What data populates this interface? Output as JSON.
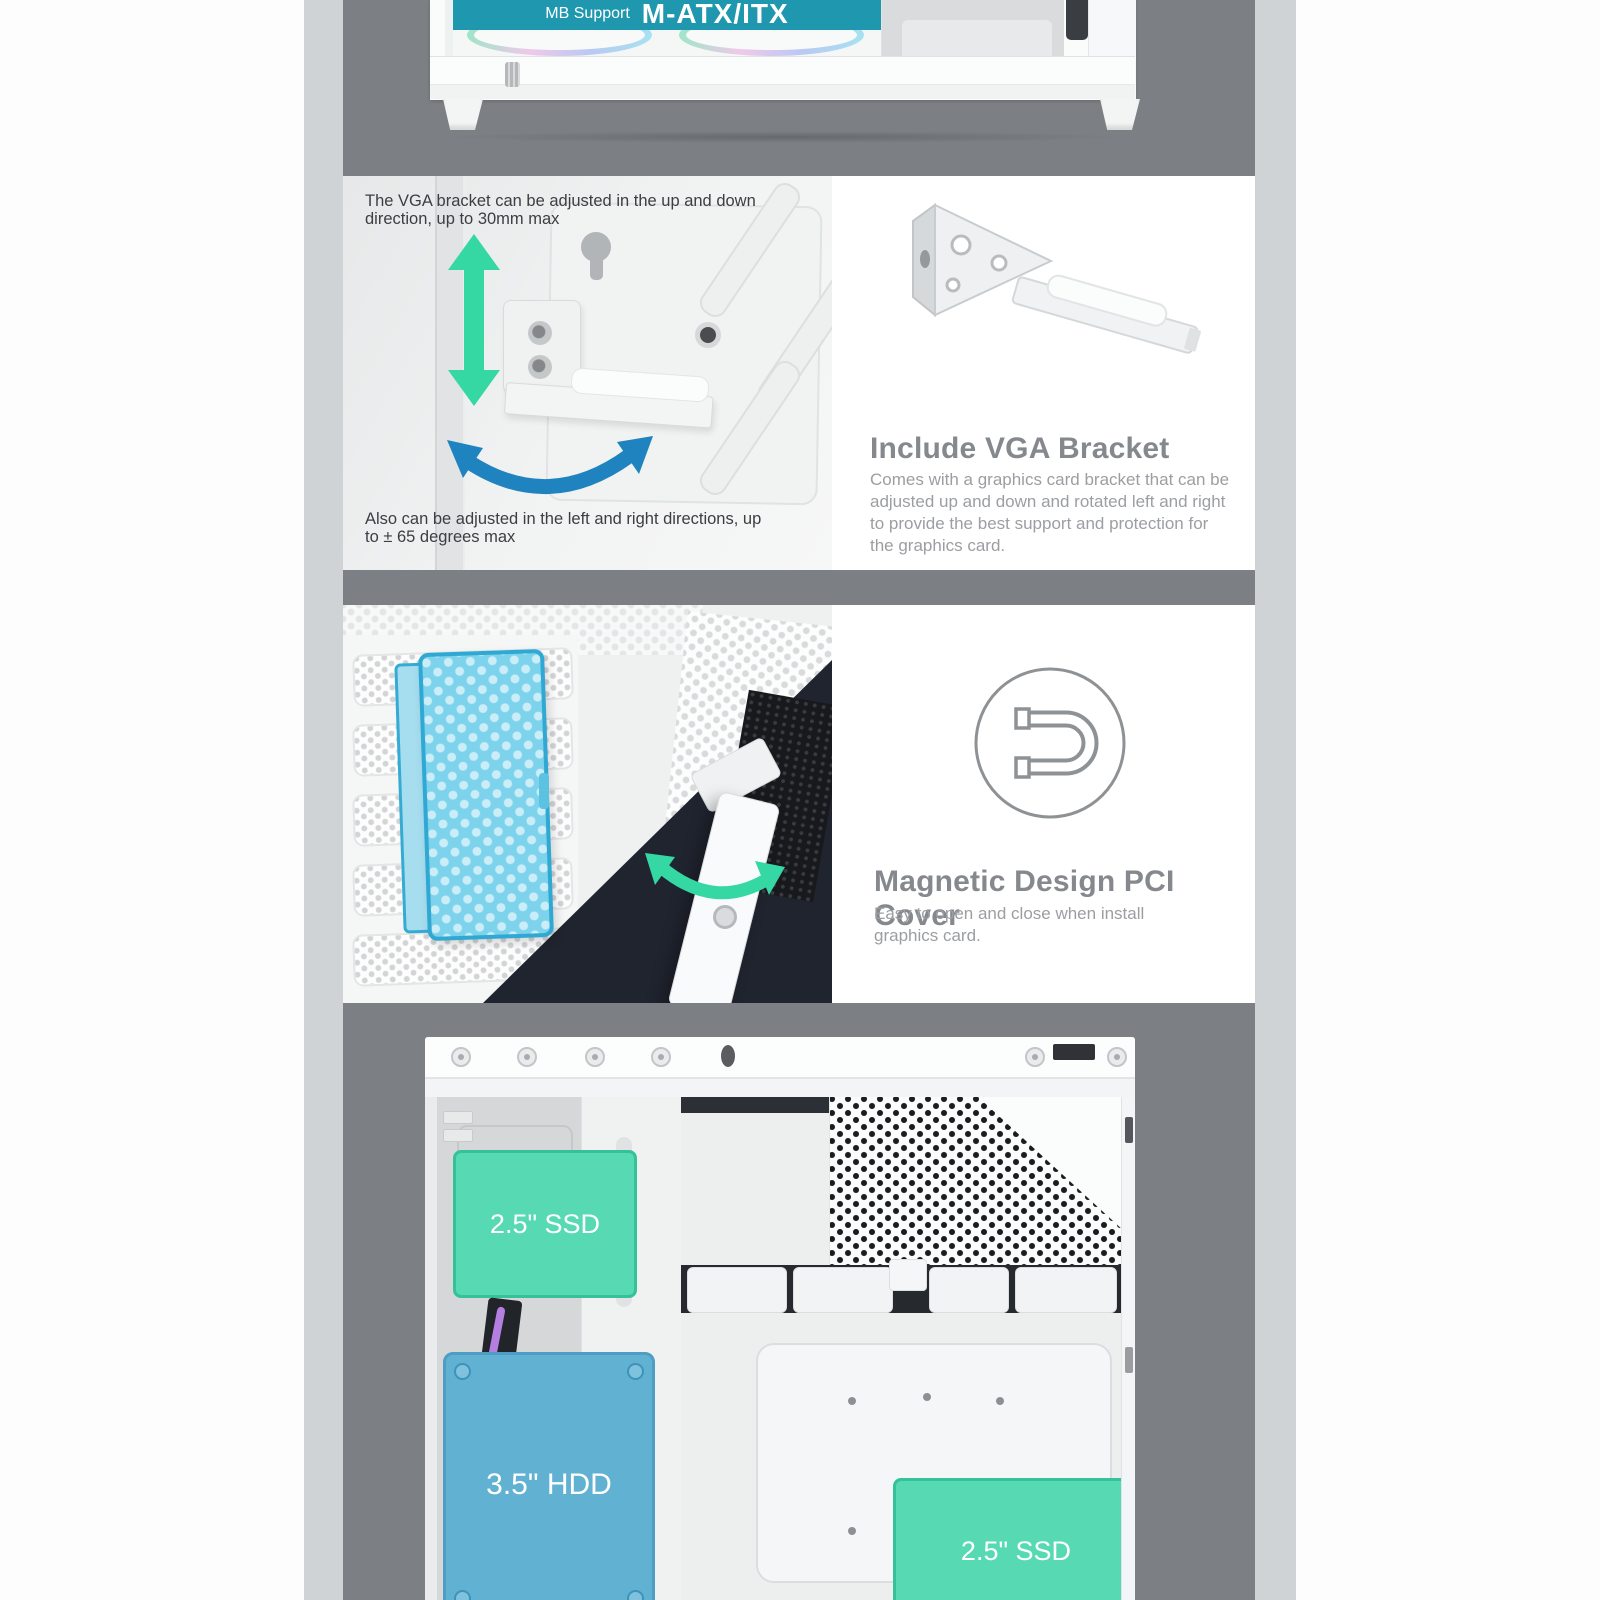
{
  "colors": {
    "page_bg": "#fdfdfe",
    "photo_band_gray": "#7c8084",
    "side_strip_gray": "#d0d3d6",
    "banner_teal": "#1f97ae",
    "arrow_green": "#35d7a3",
    "arrow_blue": "#1e83be",
    "pci_cover_blue": "#7ed3ec",
    "drive_mint": "#57dab3",
    "drive_blue": "#61b1d3",
    "navy_panel": "#20242f",
    "heading_gray": "#85888c",
    "body_text_gray": "#9b9ea2",
    "annotation_dark": "#3b3e42"
  },
  "case_bottom": {
    "banner_small": "MB Support",
    "banner_large": "M-ATX/ITX"
  },
  "vga_bracket": {
    "annotation_up_down": "The VGA bracket can be adjusted in the up and down\ndirection, up to 30mm max",
    "annotation_left_right": "Also can be adjusted in the left and right directions, up\nto ± 65 degrees max",
    "heading": "Include VGA Bracket",
    "description": "Comes with a graphics card bracket that can be\nadjusted up and down and rotated left and right\nto provide the best support and protection for\nthe graphics card."
  },
  "pci_cover": {
    "icon": "magnet-icon",
    "heading": "Magnetic Design PCI Cover",
    "description": "Easy to open and close when install\ngraphics card."
  },
  "interior": {
    "ssd_top_label": "2.5\" SSD",
    "hdd_label": "3.5\" HDD",
    "ssd_bottom_label": "2.5\" SSD"
  }
}
